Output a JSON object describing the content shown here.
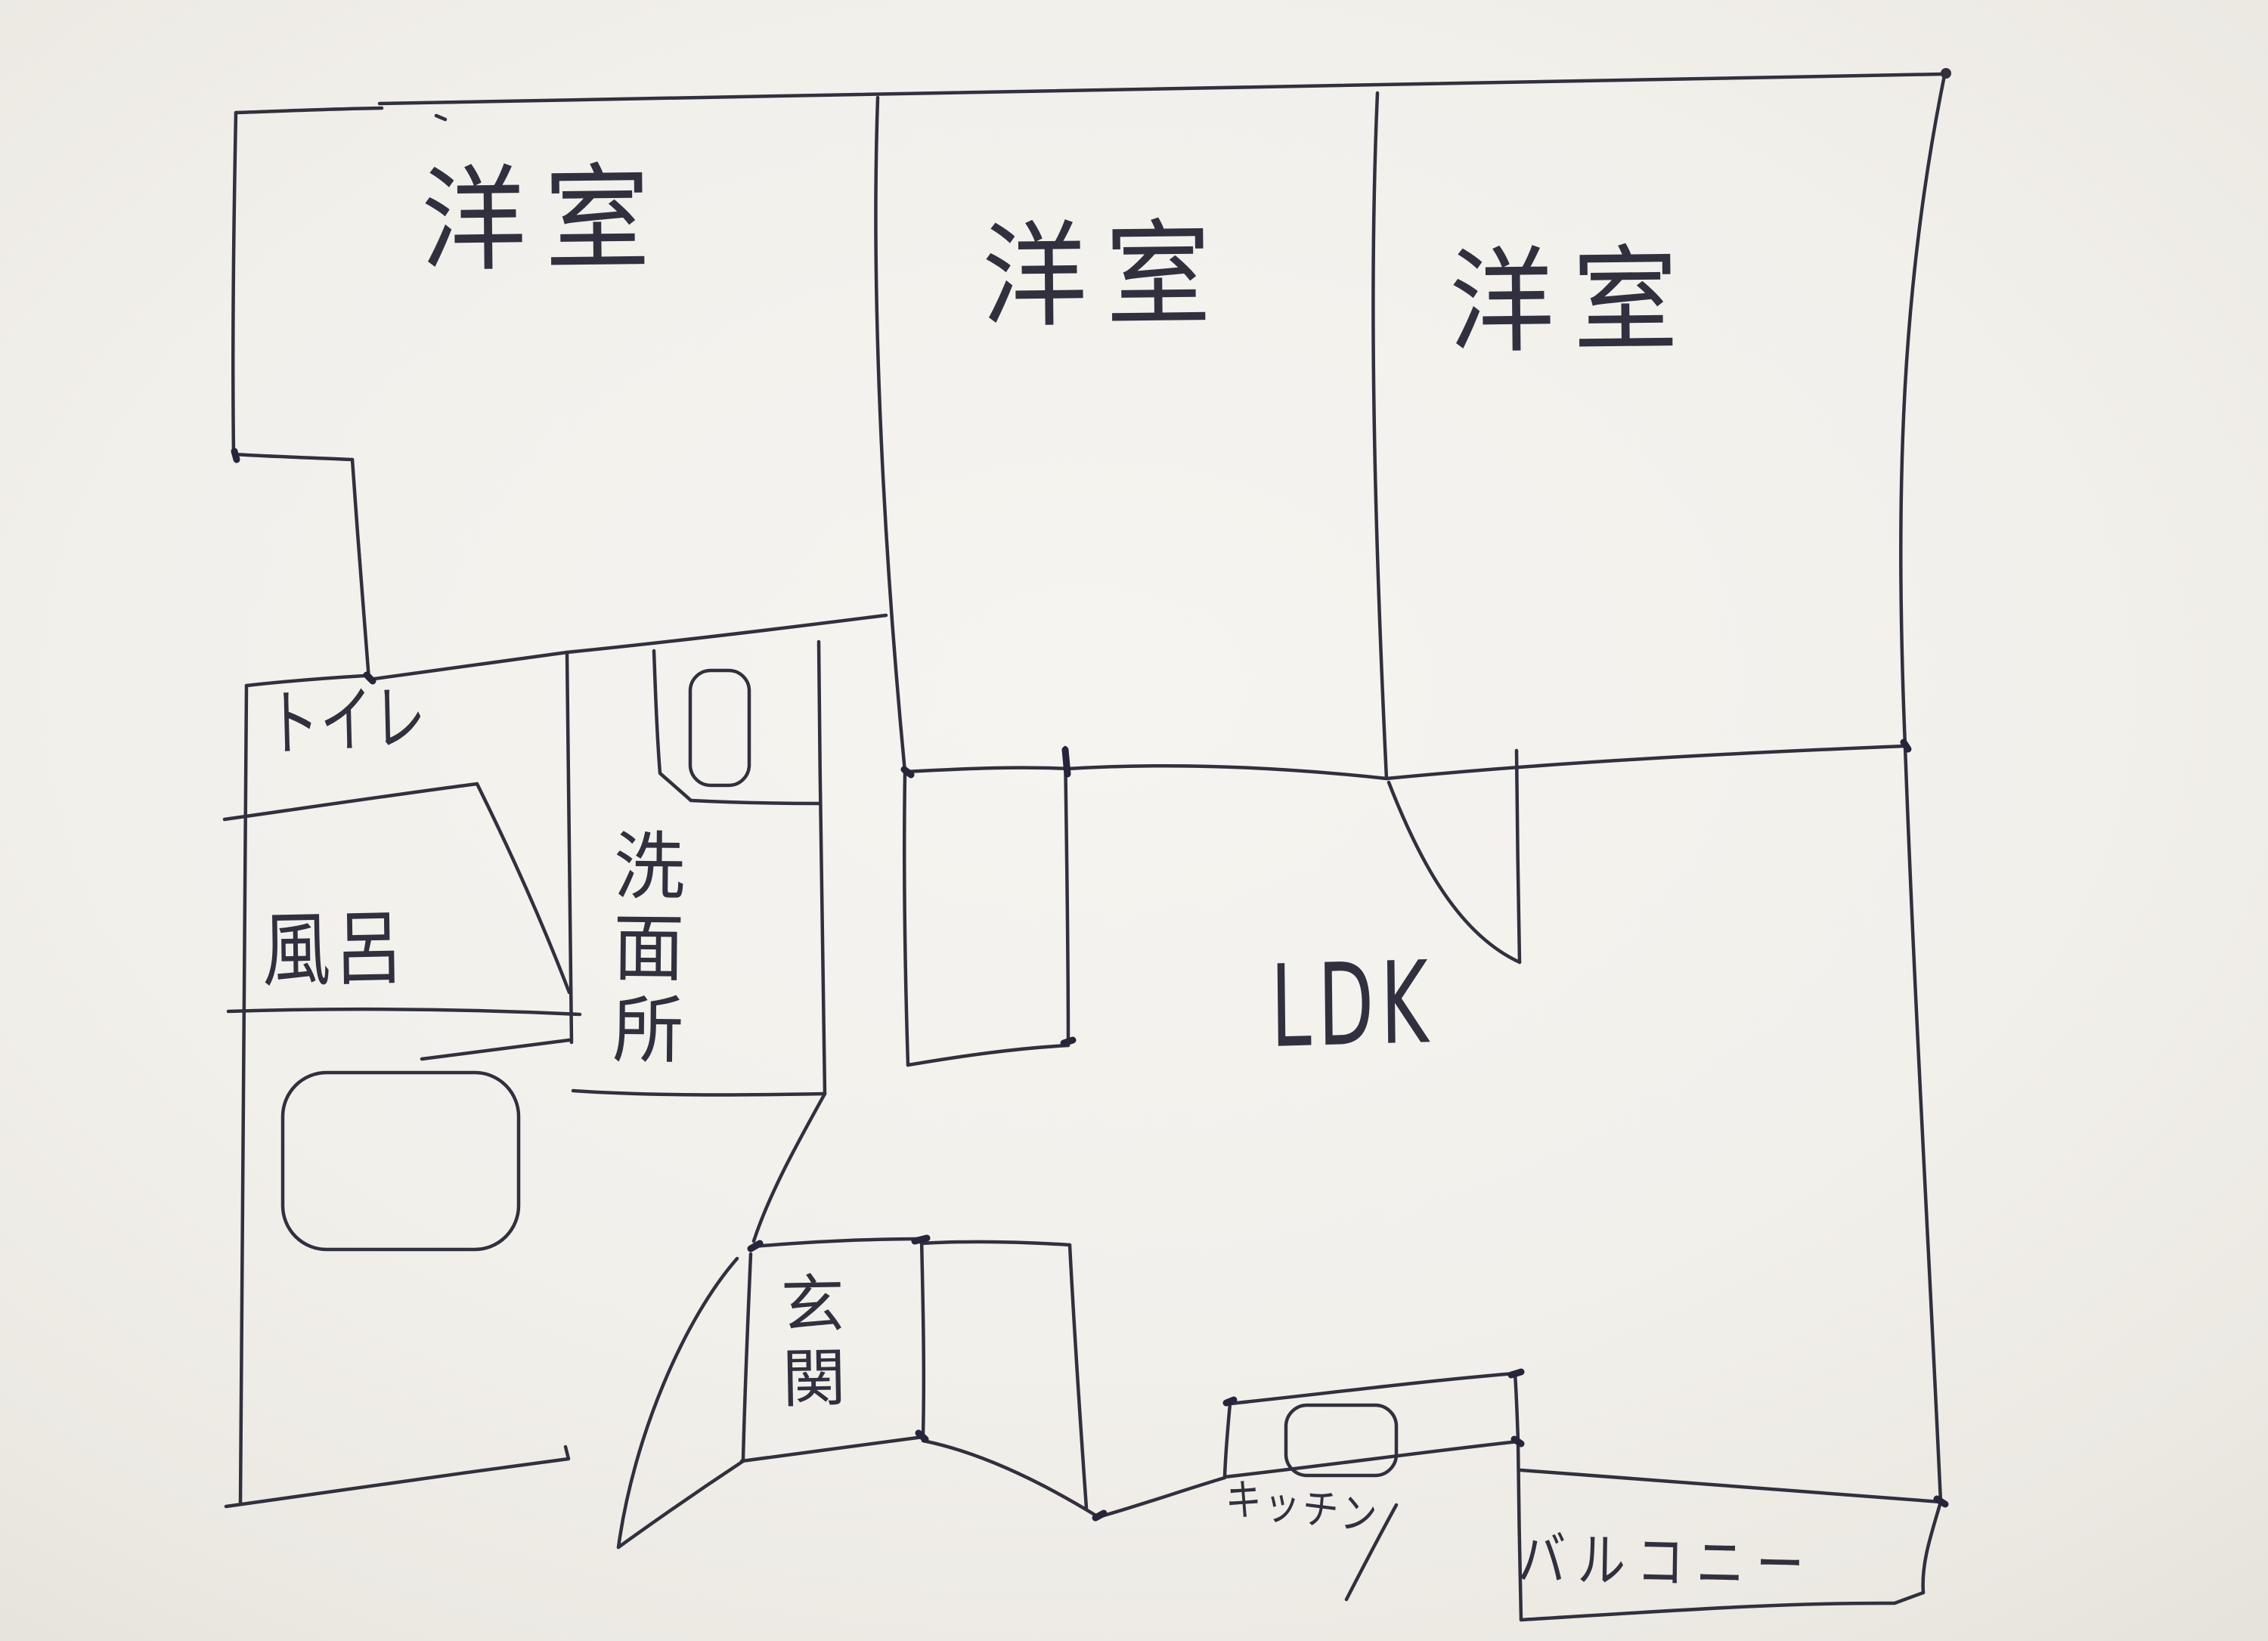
{
  "meta": {
    "kind": "hand-drawn apartment floor plan sketch",
    "ink_color": "#31303e",
    "paper_color": "#f3f1ed"
  },
  "labels": {
    "western_room_1": "洋室",
    "western_room_2": "洋室",
    "western_room_3": "洋室",
    "toilet": "トイレ",
    "bath": "風呂",
    "washroom": "洗面所",
    "entrance": "玄関",
    "ldk": "LDK",
    "kitchen": "キッチン",
    "balcony": "バルコニー"
  },
  "fixtures": [
    {
      "name": "bathtub"
    },
    {
      "name": "washbasin"
    },
    {
      "name": "kitchen-sink"
    },
    {
      "name": "entrance-door-swing"
    },
    {
      "name": "ldk-door-swing"
    },
    {
      "name": "closet-box"
    }
  ]
}
